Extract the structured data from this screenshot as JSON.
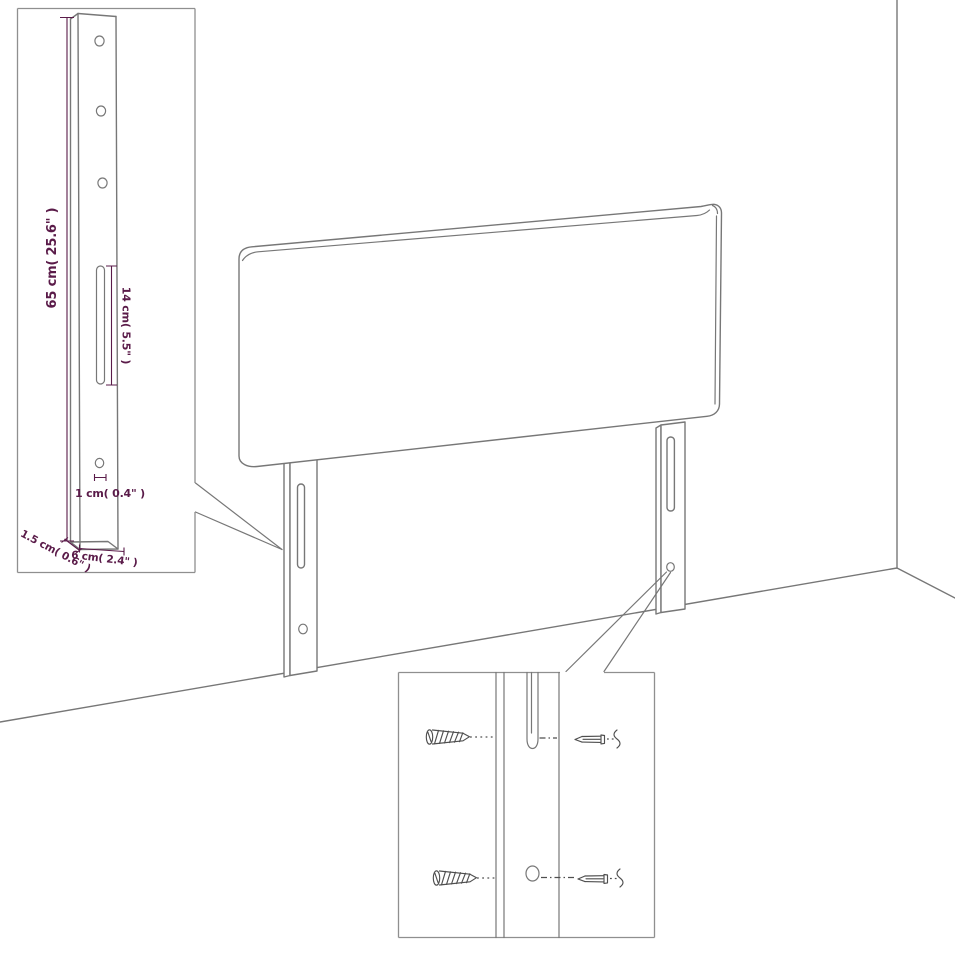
{
  "colors": {
    "drawing_line": "#777777",
    "box_border": "#8f8f8f",
    "dimension": "#5a1b49",
    "screw": "#4f4f4f",
    "background": "#ffffff"
  },
  "leg_detail": {
    "dim_height": "65 cm( 25.6\" )",
    "dim_slot": "14 cm( 5.5\" )",
    "dim_hole": "1 cm( 0.4\" )",
    "dim_thickness": "1.5 cm( 0.6\" )",
    "dim_width": "6 cm( 2.4\" )"
  }
}
